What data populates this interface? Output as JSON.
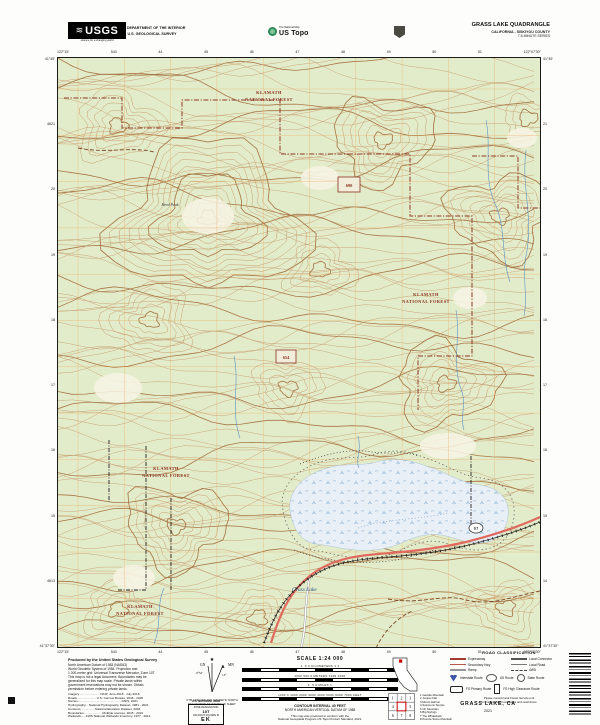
{
  "header": {
    "usgs_logo": {
      "text": "USGS",
      "tagline": "science for a changing world"
    },
    "dept_line1": "U.S. DEPARTMENT OF THE INTERIOR",
    "dept_line2": "U.S. GEOLOGICAL SURVEY",
    "ustopo": {
      "program": "The National Map",
      "brand": "US Topo"
    },
    "title": "GRASS LAKE QUADRANGLE",
    "subtitle": "CALIFORNIA - SISKIYOU COUNTY",
    "series": "7.5-MINUTE SERIES"
  },
  "edge": {
    "top": [
      "122°15'",
      "543",
      "44",
      "45",
      "46",
      "47",
      "48",
      "49",
      "50",
      "51",
      "122°07'30\""
    ],
    "bottom": [
      "122°15'",
      "543",
      "44",
      "45",
      "46",
      "47",
      "48",
      "49",
      "50",
      "51",
      "122°07'30\""
    ],
    "left": [
      "41°45'",
      "4621",
      "20",
      "19",
      "18",
      "17",
      "16",
      "15",
      "4613",
      "41°37'30\""
    ],
    "right": [
      "41°45'",
      "21",
      "20",
      "19",
      "18",
      "17",
      "16",
      "15",
      "14",
      "41°37'30\""
    ]
  },
  "map": {
    "forest": {
      "l1": "KLAMATH",
      "l2": "NATIONAL FOREST"
    },
    "lake_label": "Grass Lake",
    "peak_label": "Herd Peak",
    "box1": "690",
    "box2": "654",
    "route_shield": "97"
  },
  "footer": {
    "produced": [
      "Produced by the United States Geological Survey",
      "North American Datum of 1983 (NAD83)",
      "World Geodetic System of 1984. Projection and",
      "1 000-meter grid: Universal Transverse Mercator, Zone 10T",
      "This map is not a legal document. Boundaries may be",
      "generalized for this map scale. Private lands within",
      "government reservations may not be shown. Obtain",
      "permission before entering private lands."
    ],
    "credits": [
      "Imagery.........................NAIP, June 2018 - July 2018",
      "Roads.......................U.S. Census Bureau, 2016 - 2020",
      "Names...................................................GNIS, 2021",
      "Hydrography....National Hydrography Dataset, 1981 - 2021",
      "Contours.................National Elevation Dataset, 2002",
      "Boundaries......................Multiple sources, 2015 - 2021",
      "Wetlands......FWS National Wetlands Inventory, 1977 - 2014"
    ],
    "declination": {
      "star": "★",
      "gn": "GN",
      "mn": "MN",
      "gn_angle": "0°52'",
      "mn_angle": "13°",
      "caption1": "UTM GRID AND 2021 MAGNETIC NORTH",
      "caption2": "DECLINATION AT CENTER OF SHEET"
    },
    "usng": {
      "title": "U.S. NATIONAL GRID",
      "zone_label": "ZONE DESIGNATION",
      "zone": "10T",
      "square_label": "100,000-M SQUARE ID",
      "square_id": "EK"
    },
    "scale": {
      "title": "SCALE 1:24 000",
      "bars": [
        "1    .5    0    KILOMETERS    1    2",
        "1000    500    0    METERS    1000    2000",
        "1    .5    0    MILES    1",
        "1000  0  1000  2000  3000  4000  5000  6000  7000   FEET"
      ],
      "contour_interval": "CONTOUR INTERVAL 40 FEET",
      "datum": "NORTH AMERICAN VERTICAL DATUM OF 1988",
      "standard1": "This map was produced to conform with the",
      "standard2": "National Geospatial Program US Topo Product Standard, 2021."
    },
    "state": {
      "caption": "CALIFORNIA"
    },
    "adjoining": {
      "caption": "ADJOINING QUADRANGLES",
      "cells": [
        "1",
        "2",
        "3",
        "4",
        "5",
        "6",
        "7",
        "8"
      ],
      "list": [
        "1 Gazelle Mountain",
        "2 Juniper Flat",
        "3 Mount Hebron",
        "4 Solomons Temple",
        "5 Orr Mountain",
        "6 Big Springs",
        "7 The Whaleback",
        "8 Pumice Stone Mountain"
      ]
    },
    "legend": {
      "title": "ROAD CLASSIFICATION",
      "labels": [
        "Expressway",
        "Local Connector",
        "Secondary Hwy",
        "Local Road",
        "Ramp",
        "4WD"
      ],
      "shields": [
        "Interstate Route",
        "US Route",
        "State Route",
        "FS Primary Route",
        "FS High Clearance Route"
      ],
      "note1": "Please consult local Forest Service unit",
      "note2": "for current travel conditions and restrictions"
    },
    "sheet_name": "GRASS LAKE,  CA",
    "year": "2021"
  },
  "colors": {
    "map_green": "#e3ecca",
    "contour_brown": "#c49a6c",
    "index_contour": "#a3713f",
    "grid_orange": "#eba14e",
    "highway_red": "#e06a5e",
    "water_blue": "#5e93c4",
    "boundary_red": "#8c3a26",
    "forest_label_red": "#8b3020"
  }
}
